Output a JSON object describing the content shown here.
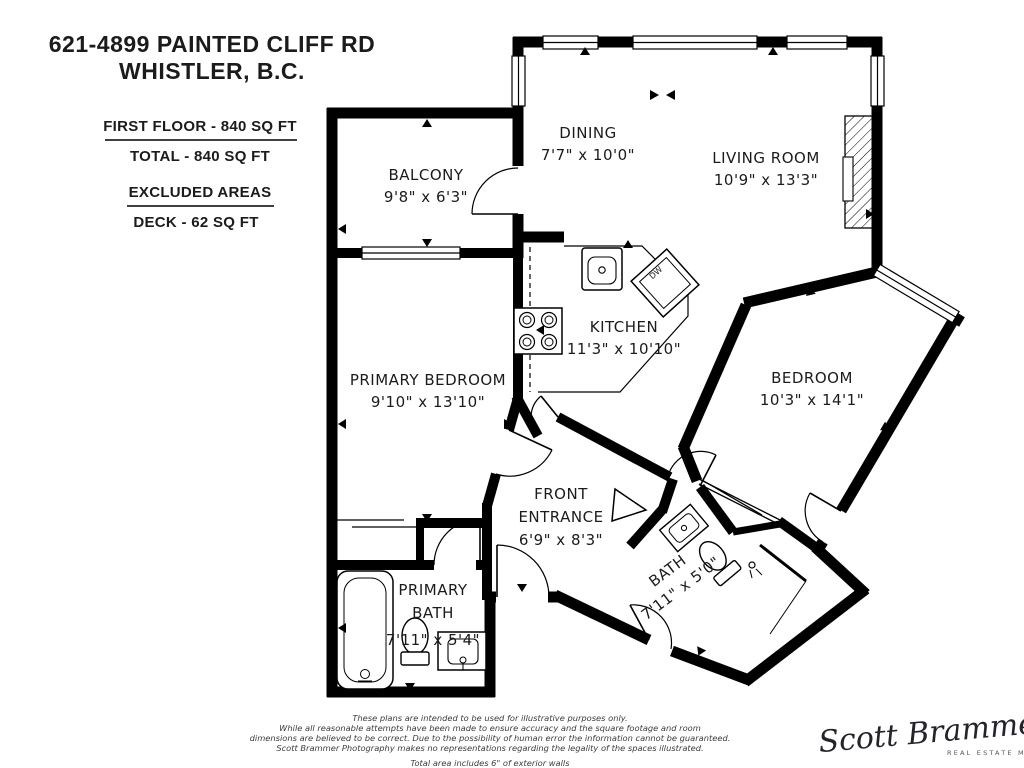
{
  "header": {
    "title_line1": "621-4899 PAINTED CLIFF RD",
    "title_line2": "WHISTLER, B.C."
  },
  "area_summary": {
    "first_floor": "FIRST FLOOR - 840 SQ FT",
    "total": "TOTAL  -  840 SQ FT",
    "excluded_heading": "EXCLUDED AREAS",
    "excluded_item": "DECK - 62 SQ FT"
  },
  "rooms": {
    "balcony": {
      "name": "BALCONY",
      "dims": "9'8\" x 6'3\""
    },
    "dining": {
      "name": "DINING",
      "dims": "7'7\" x 10'0\""
    },
    "living": {
      "name": "LIVING ROOM",
      "dims": "10'9\" x 13'3\""
    },
    "kitchen": {
      "name": "KITCHEN",
      "dims": "11'3\" x 10'10\""
    },
    "primary_bedroom": {
      "name": "PRIMARY BEDROOM",
      "dims": "9'10\" x 13'10\""
    },
    "bedroom": {
      "name": "BEDROOM",
      "dims": "10'3\" x 14'1\""
    },
    "front_entrance": {
      "line1": "FRONT",
      "line2": "ENTRANCE",
      "dims": "6'9\" x 8'3\""
    },
    "primary_bath": {
      "line1": "PRIMARY",
      "line2": "BATH",
      "dims": "7'11\" x 5'4\""
    },
    "bath": {
      "name": "BATH",
      "dims": "7'11\" x 5'0\""
    }
  },
  "fixtures": {
    "dishwasher_label": "DW"
  },
  "disclaimer": {
    "line1": "These plans are intended to be used for illustrative purposes only.",
    "line2": "While all reasonable attempts have been made to ensure accuracy and the square footage and room",
    "line3": "dimensions are believed to be correct.  Due to the possibility of human error the information cannot be guaranteed.",
    "line4": "Scott Brammer Photography makes no representations regarding the legality of the spaces illustrated.",
    "note": "Total area includes 6\" of exterior walls"
  },
  "logo": {
    "name": "Scott Brammer",
    "tagline": "REAL ESTATE MEDIA"
  },
  "colors": {
    "walls": "#000000",
    "background": "#ffffff",
    "text": "#1b1b1b"
  }
}
